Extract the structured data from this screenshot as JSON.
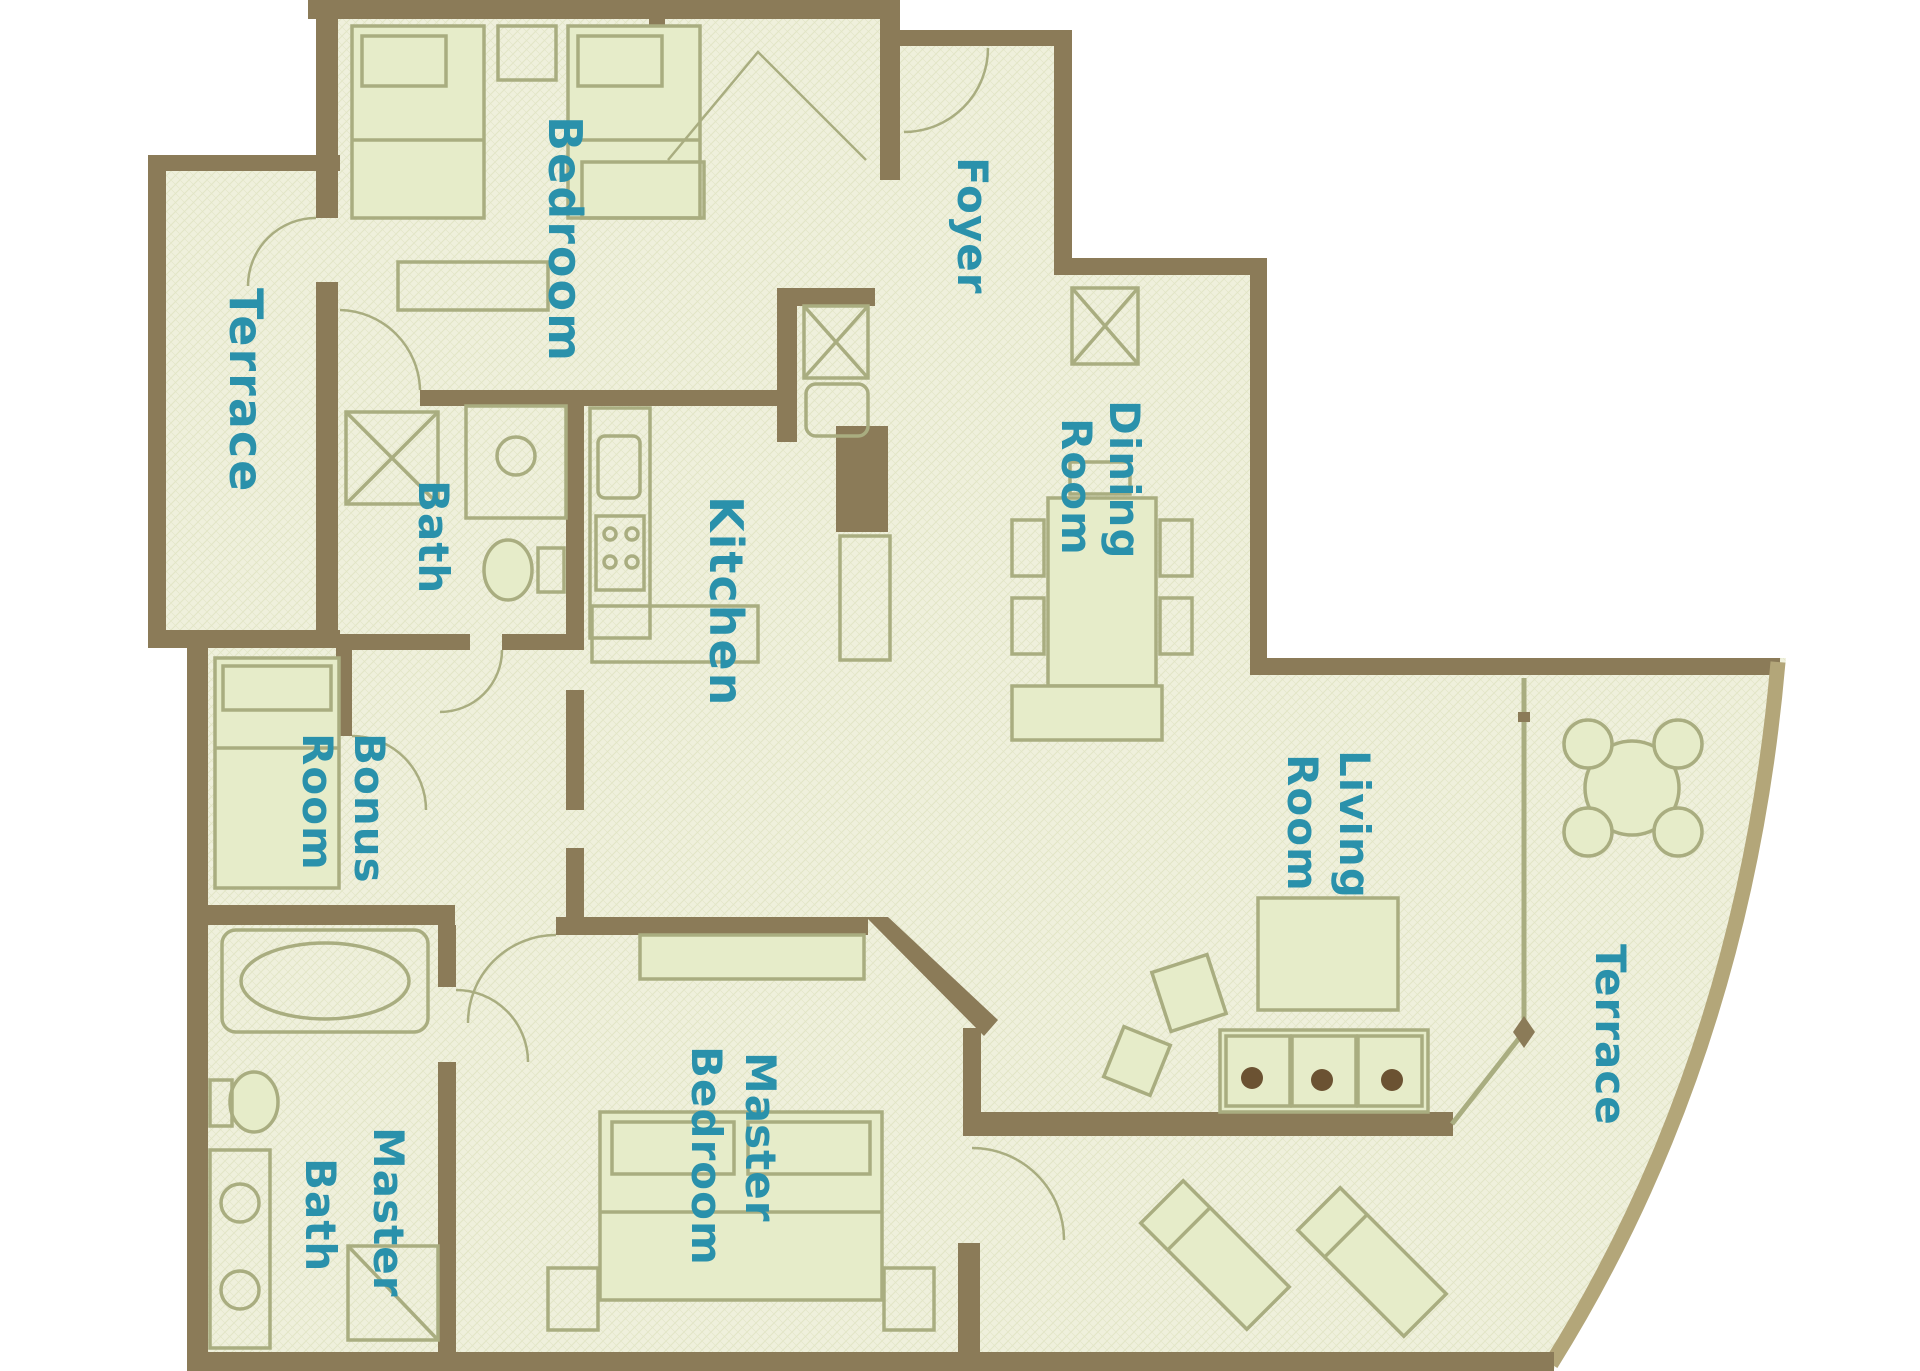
{
  "title": "Condominium unit floor plan",
  "colors": {
    "background": "#ffffff",
    "floor": "#eff0dc",
    "floor_texture": "#e2e5c6",
    "wall": "#8b7b58",
    "wall_light": "#b3a679",
    "label": "#2a91ab",
    "furniture": "#a9ad80",
    "furniture_fill": "#e6ecc9",
    "accent_dot": "#6b5232"
  },
  "labels": {
    "bedroom": "Bedroom",
    "foyer": "Foyer",
    "terrace_upper": "Terrace",
    "bath": "Bath",
    "kitchen": "Kitchen",
    "dining": {
      "line1": "Dining",
      "line2": "Room"
    },
    "living": {
      "line1": "Living",
      "line2": "Room"
    },
    "bonus": {
      "line1": "Bonus",
      "line2": "Room"
    },
    "master_bath": {
      "line1": "Master",
      "line2": "Bath"
    },
    "master_bedroom": {
      "line1": "Master",
      "line2": "Bedroom"
    },
    "terrace_lower": "Terrace"
  }
}
